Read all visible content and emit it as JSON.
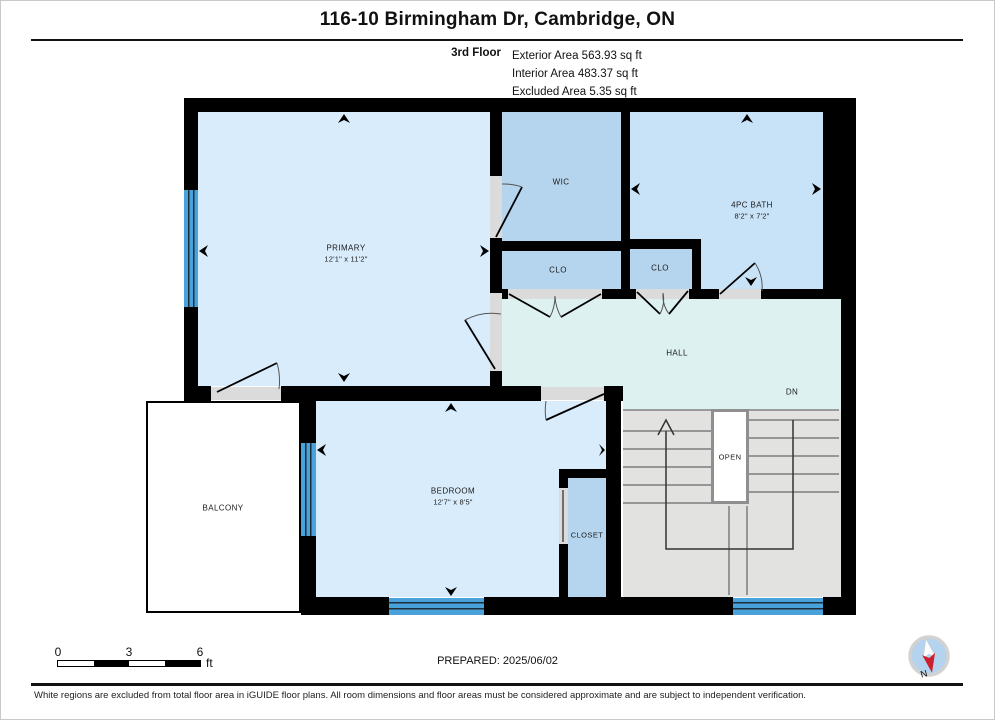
{
  "header": {
    "title": "116-10 Birmingham Dr, Cambridge, ON",
    "floor_label": "3rd Floor",
    "area_lines": [
      "Exterior Area 563.93 sq ft",
      "Interior Area 483.37 sq ft",
      "Excluded Area 5.35 sq ft"
    ]
  },
  "plan": {
    "rooms": {
      "primary": {
        "name": "PRIMARY",
        "dims": "12'1\" x 11'2\""
      },
      "wic": {
        "name": "WIC"
      },
      "bath": {
        "name": "4PC BATH",
        "dims": "8'2\" x 7'2\""
      },
      "clo1": {
        "name": "CLO"
      },
      "clo2": {
        "name": "CLO"
      },
      "hall": {
        "name": "HALL"
      },
      "bedroom": {
        "name": "BEDROOM",
        "dims": "12'7\" x 8'5\""
      },
      "closet": {
        "name": "CLOSET"
      },
      "balcony": {
        "name": "BALCONY"
      }
    },
    "stairs": {
      "open_label": "OPEN",
      "down_label": "DN"
    }
  },
  "footer_bar": {
    "scale": {
      "ticks": [
        "0",
        "3",
        "6"
      ],
      "unit": "ft"
    },
    "prepared": "PREPARED: 2025/06/02",
    "compass_label": "N"
  },
  "disclaimer": "White regions are excluded from total floor area in iGUIDE floor plans. All room dimensions and floor areas must be considered approximate and are subject to independent verification.",
  "colors": {
    "wall": "#000000",
    "window": "#49a2d9",
    "room_light": "#d9ecfb",
    "room_bath": "#c8e3f8",
    "room_medium": "#b5d5ee",
    "hall": "#ddf1f0",
    "stairs": "#e2e2e1",
    "opening": "#dbdbdb",
    "compass_red": "#cc202e"
  }
}
